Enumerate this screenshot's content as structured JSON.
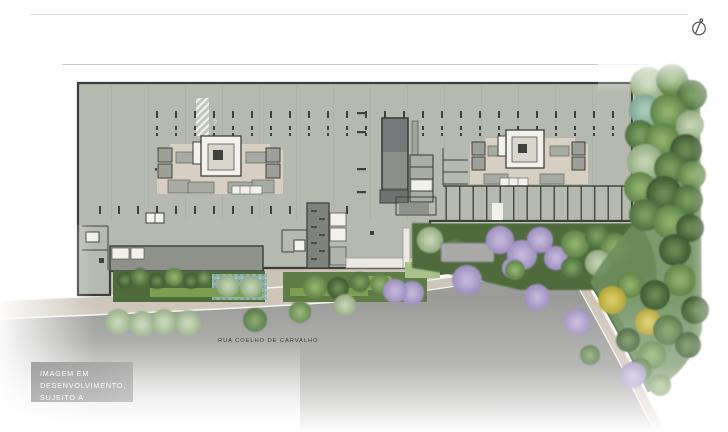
{
  "plan": {
    "street_label": "RUA COELHO DE CARVALHO",
    "disclaimer": {
      "lines": [
        "IMAGEM EM",
        "DESENVOLVIMENTO,",
        "SUJEITO A ALTERAÇÃO"
      ]
    },
    "hatch_mark": "?",
    "icons": {
      "north_indicator": "north-compass-icon"
    }
  },
  "colors": {
    "slab": "#b6b9af",
    "slab_border": "#3c3e3b",
    "core_floor": "#d8cfc3",
    "core_white": "#f3f1eb",
    "shaft_gray": "#9da099",
    "ramp_dark": "#767879",
    "ramp_mid": "#8c8e8b",
    "podium": "#8f918b",
    "plaza_white": "#ebe9e2",
    "street": "#9b9b99",
    "sidewalk": "#cdc5b8",
    "hedge": "#49653c",
    "bed_dark": "#4f6a3b",
    "bed_teal": "#8fb3a6",
    "bush_bright": "#7ca04f",
    "lawn": "#a9c18c",
    "tree_green": "#5f8348",
    "tree_green_dark": "#3c5a31",
    "tree_sage": "#93ab82",
    "tree_purple": "#9d8fc0",
    "tree_yellow": "#b3a433",
    "forest_teal": "#7fa895",
    "disclaimer_bg_top": "#979797e0",
    "disclaimer_bg_bottom": "#bdbdbdd0",
    "text_dark": "#3f3f3f",
    "text_light": "#fbfbfb"
  }
}
